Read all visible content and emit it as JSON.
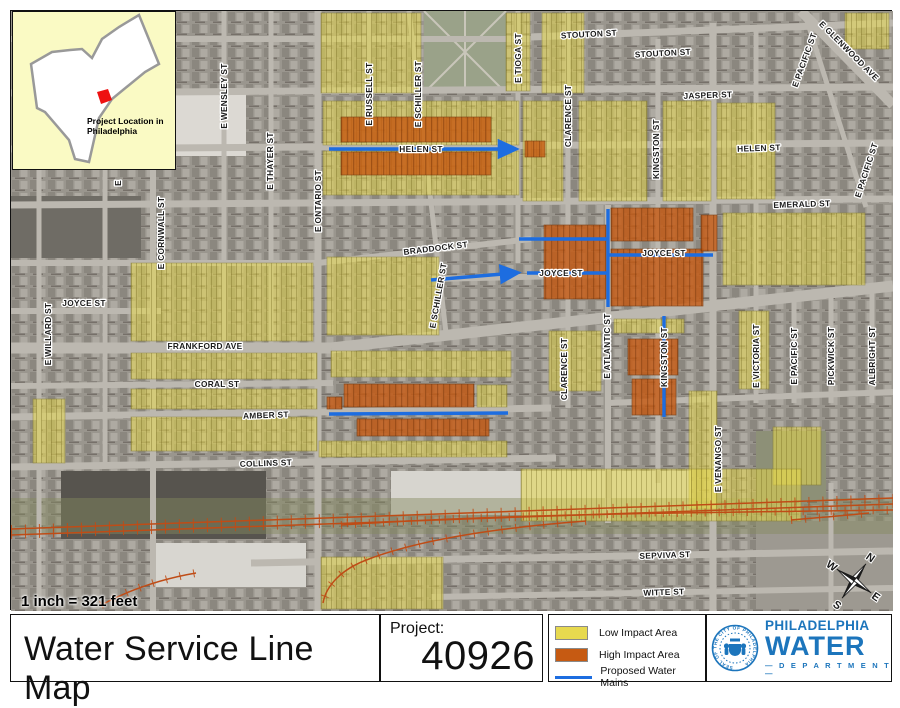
{
  "inset": {
    "caption_line1": "Project Location in",
    "caption_line2": "Philadelphia"
  },
  "title_bar": {
    "title": "Water Service Line Map",
    "project_label": "Project:",
    "project_number": "40926"
  },
  "legend": {
    "items": [
      {
        "label": "Low Impact Area",
        "kind": "swatch",
        "color": "#e7d94f"
      },
      {
        "label": "High Impact Area",
        "kind": "swatch",
        "color": "#c65a12"
      },
      {
        "label": "Proposed Water Mains",
        "kind": "line",
        "color": "#1d6de0"
      }
    ]
  },
  "logo": {
    "line1": "PHILADELPHIA",
    "line2": "WATER",
    "line3": "— D E P A R T M E N T —",
    "seal_text": "SEAL OF THE CITY OF PHILADELPHIA",
    "color": "#1c75bc"
  },
  "map": {
    "scale_note": "1 inch = 321 feet",
    "compass": {
      "n": "N",
      "e": "E",
      "s": "S",
      "w": "W"
    },
    "colors": {
      "low_impact": "#e7d94f",
      "high_impact": "#c65a12",
      "water_main": "#1d6de0",
      "railroad": "#bf4c16",
      "street": "#bcb8b0",
      "label": "#1b1b1b"
    },
    "streets": [
      [
        0,
        28,
        520,
        28,
        6
      ],
      [
        520,
        26,
        882,
        12,
        7
      ],
      [
        0,
        82,
        882,
        76,
        7
      ],
      [
        0,
        138,
        882,
        132,
        7
      ],
      [
        0,
        194,
        882,
        188,
        7
      ],
      [
        0,
        252,
        307,
        252,
        6
      ],
      [
        307,
        252,
        520,
        228,
        6
      ],
      [
        420,
        268,
        597,
        264,
        6
      ],
      [
        597,
        246,
        702,
        243,
        5
      ],
      [
        0,
        300,
        150,
        300,
        6
      ],
      [
        0,
        337,
        320,
        337,
        11
      ],
      [
        320,
        337,
        882,
        275,
        11
      ],
      [
        0,
        375,
        322,
        372,
        6
      ],
      [
        0,
        406,
        540,
        397,
        7
      ],
      [
        0,
        456,
        545,
        447,
        7
      ],
      [
        240,
        552,
        882,
        540,
        7
      ],
      [
        420,
        586,
        882,
        577,
        6
      ],
      [
        597,
        392,
        882,
        381,
        6
      ],
      [
        28,
        0,
        28,
        600,
        5
      ],
      [
        94,
        0,
        94,
        455,
        5
      ],
      [
        142,
        0,
        142,
        600,
        6
      ],
      [
        213,
        0,
        213,
        337,
        5
      ],
      [
        260,
        0,
        260,
        337,
        5
      ],
      [
        307,
        0,
        307,
        600,
        7
      ],
      [
        358,
        0,
        358,
        82,
        5
      ],
      [
        398,
        0,
        435,
        322,
        5
      ],
      [
        507,
        0,
        507,
        252,
        5
      ],
      [
        557,
        0,
        557,
        397,
        5
      ],
      [
        597,
        194,
        597,
        512,
        6
      ],
      [
        647,
        28,
        647,
        472,
        5
      ],
      [
        702,
        12,
        702,
        600,
        7
      ],
      [
        745,
        14,
        745,
        392,
        5
      ],
      [
        783,
        288,
        783,
        392,
        5
      ],
      [
        820,
        277,
        820,
        392,
        5
      ],
      [
        820,
        472,
        820,
        600,
        5
      ],
      [
        861,
        277,
        861,
        392,
        5
      ],
      [
        790,
        0,
        882,
        94,
        10
      ],
      [
        793,
        0,
        855,
        196,
        5
      ]
    ],
    "low_impact_areas": [
      [
        310,
        2,
        100,
        80
      ],
      [
        495,
        2,
        24,
        78
      ],
      [
        531,
        2,
        42,
        80
      ],
      [
        312,
        90,
        196,
        44
      ],
      [
        312,
        140,
        196,
        44
      ],
      [
        512,
        90,
        40,
        100
      ],
      [
        568,
        90,
        68,
        100
      ],
      [
        652,
        90,
        48,
        100
      ],
      [
        706,
        92,
        58,
        96
      ],
      [
        712,
        202,
        142,
        72
      ],
      [
        316,
        246,
        112,
        78
      ],
      [
        120,
        252,
        182,
        78
      ],
      [
        120,
        342,
        186,
        26
      ],
      [
        320,
        340,
        180,
        26
      ],
      [
        120,
        378,
        186,
        20
      ],
      [
        120,
        406,
        186,
        34
      ],
      [
        308,
        430,
        188,
        16
      ],
      [
        538,
        320,
        52,
        60
      ],
      [
        678,
        380,
        28,
        118
      ],
      [
        728,
        300,
        30,
        78
      ],
      [
        762,
        416,
        48,
        58
      ],
      [
        510,
        458,
        280,
        52
      ],
      [
        310,
        546,
        122,
        52
      ],
      [
        466,
        374,
        30,
        22
      ],
      [
        22,
        388,
        32,
        64
      ],
      [
        834,
        2,
        44,
        36
      ],
      [
        603,
        308,
        70,
        14
      ]
    ],
    "high_impact_areas": [
      [
        330,
        106,
        150,
        25
      ],
      [
        330,
        141,
        150,
        23
      ],
      [
        514,
        130,
        20,
        16
      ],
      [
        533,
        214,
        62,
        74
      ],
      [
        600,
        197,
        82,
        33
      ],
      [
        600,
        238,
        92,
        57
      ],
      [
        690,
        204,
        16,
        36
      ],
      [
        617,
        328,
        50,
        36
      ],
      [
        621,
        368,
        44,
        36
      ],
      [
        333,
        373,
        130,
        23
      ],
      [
        346,
        408,
        132,
        17
      ],
      [
        316,
        386,
        15,
        12
      ]
    ],
    "water_mains": [
      {
        "pts": [
          [
            318,
            138
          ],
          [
            502,
            138
          ]
        ],
        "arrow": true
      },
      {
        "pts": [
          [
            420,
            269
          ],
          [
            504,
            262
          ]
        ],
        "arrow": true
      },
      {
        "pts": [
          [
            516,
            262
          ],
          [
            597,
            262
          ]
        ]
      },
      {
        "pts": [
          [
            508,
            228
          ],
          [
            597,
            228
          ]
        ]
      },
      {
        "pts": [
          [
            597,
            198
          ],
          [
            597,
            296
          ]
        ]
      },
      {
        "pts": [
          [
            597,
            244
          ],
          [
            702,
            244
          ]
        ]
      },
      {
        "pts": [
          [
            653,
            305
          ],
          [
            653,
            406
          ]
        ]
      },
      {
        "pts": [
          [
            318,
            403
          ],
          [
            497,
            402
          ]
        ]
      }
    ],
    "railroads": [
      "M0,524 L882,493",
      "M0,518 L882,487",
      "M330,514 C510,502 690,502 882,499",
      "M575,510 C470,518 400,532 358,548 C330,558 315,575 312,592",
      "M90,594 C120,578 150,568 185,562",
      "M780,509 C815,506 840,504 858,502"
    ],
    "street_labels": [
      {
        "t": "STOUTON ST",
        "x": 578,
        "y": 26,
        "r": -3
      },
      {
        "t": "STOUTON ST",
        "x": 652,
        "y": 45,
        "r": -3
      },
      {
        "t": "JASPER ST",
        "x": 697,
        "y": 87,
        "r": -2
      },
      {
        "t": "HELEN ST",
        "x": 410,
        "y": 141
      },
      {
        "t": "HELEN ST",
        "x": 748,
        "y": 140,
        "r": -2
      },
      {
        "t": "EMERALD ST",
        "x": 791,
        "y": 196,
        "r": -2
      },
      {
        "t": "BRADDOCK ST",
        "x": 425,
        "y": 240,
        "r": -7
      },
      {
        "t": "JOYCE ST",
        "x": 550,
        "y": 265
      },
      {
        "t": "JOYCE ST",
        "x": 653,
        "y": 245
      },
      {
        "t": "JOYCE ST",
        "x": 73,
        "y": 295
      },
      {
        "t": "FRANKFORD AVE",
        "x": 194,
        "y": 338
      },
      {
        "t": "CORAL ST",
        "x": 206,
        "y": 376
      },
      {
        "t": "AMBER ST",
        "x": 255,
        "y": 407,
        "r": -2
      },
      {
        "t": "COLLINS ST",
        "x": 255,
        "y": 455,
        "r": -2
      },
      {
        "t": "SEPVIVA ST",
        "x": 654,
        "y": 547,
        "r": -2
      },
      {
        "t": "WITTE ST",
        "x": 653,
        "y": 584,
        "r": -2
      },
      {
        "t": "E WENSLEY ST",
        "x": 216,
        "y": 85,
        "r": -90
      },
      {
        "t": "E THAYER ST",
        "x": 262,
        "y": 150,
        "r": -90
      },
      {
        "t": "E RUSSELL ST",
        "x": 361,
        "y": 83,
        "r": -90
      },
      {
        "t": "E SCHILLER ST",
        "x": 410,
        "y": 83,
        "r": -90
      },
      {
        "t": "E SCHILLER ST",
        "x": 430,
        "y": 285,
        "r": -80
      },
      {
        "t": "E TIOGA ST",
        "x": 510,
        "y": 47,
        "r": -90
      },
      {
        "t": "E ONTARIO ST",
        "x": 310,
        "y": 190,
        "r": -90
      },
      {
        "t": "E CORNWALL ST",
        "x": 153,
        "y": 222,
        "r": -90
      },
      {
        "t": "E WILLARD ST",
        "x": 40,
        "y": 323,
        "r": -90
      },
      {
        "t": "E",
        "x": 110,
        "y": 172,
        "r": -90
      },
      {
        "t": "CLARENCE ST",
        "x": 560,
        "y": 105,
        "r": -90
      },
      {
        "t": "CLARENCE ST",
        "x": 556,
        "y": 358,
        "r": -90
      },
      {
        "t": "KINGSTON ST",
        "x": 648,
        "y": 138,
        "r": -90
      },
      {
        "t": "KINGSTON ST",
        "x": 656,
        "y": 346,
        "r": -90
      },
      {
        "t": "E ATLANTIC ST",
        "x": 599,
        "y": 335,
        "r": -90
      },
      {
        "t": "E VICTORIA ST",
        "x": 748,
        "y": 345,
        "r": -90
      },
      {
        "t": "E PACIFIC ST",
        "x": 796,
        "y": 50,
        "r": -70
      },
      {
        "t": "E PACIFIC ST",
        "x": 858,
        "y": 160,
        "r": -72
      },
      {
        "t": "E PACIFIC ST",
        "x": 786,
        "y": 345,
        "r": -90
      },
      {
        "t": "PICKWICK ST",
        "x": 823,
        "y": 345,
        "r": -90
      },
      {
        "t": "ALBRIGHT ST",
        "x": 864,
        "y": 345,
        "r": -90
      },
      {
        "t": "E VENANGO ST",
        "x": 710,
        "y": 448,
        "r": -90
      },
      {
        "t": "E GLENWOOD AVE",
        "x": 836,
        "y": 42,
        "r": 45
      }
    ]
  }
}
